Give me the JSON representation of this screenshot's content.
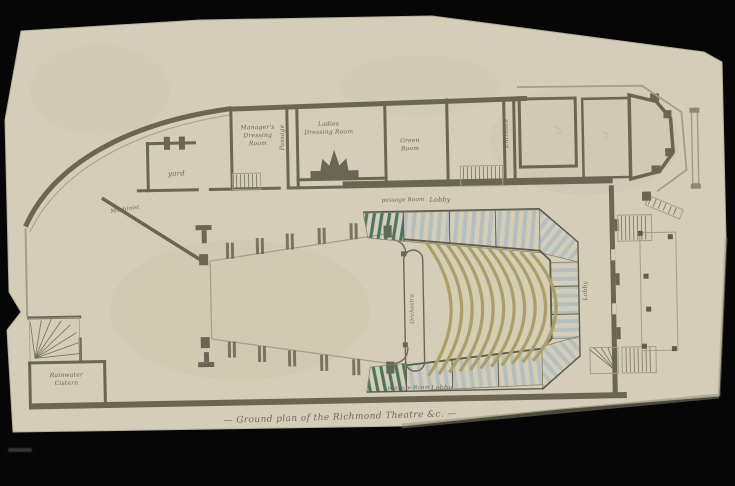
{
  "photo": {
    "background_color": "#060606",
    "paper_color": "#d6cfba",
    "ink_color": "#696653",
    "light_line_color": "#a59e87",
    "pit_bench_color": "#ab9f62",
    "box_stripe_blue": "#b5bfbf",
    "box_stripe_green": "#4a7660",
    "text_color": "#6b6453"
  },
  "title": {
    "inscription": "— Ground plan of the Richmond Theatre &c. —"
  },
  "rooms": {
    "yard": "yard",
    "machinist": "Machinist",
    "managers_dressing_room": "Manager's\nDressing\nRoom",
    "passage": "Passage",
    "ladies_dressing_room": "Ladies\nDressing Room",
    "green_room": "Green\nRoom",
    "entrance": "Entrance",
    "cistern": "Rainwater\nCistern"
  },
  "auditorium": {
    "lobby_top": "Lobby",
    "lobby_bottom": "Lobby",
    "lobby_right": "Lobby",
    "passage_top": "passage Room",
    "passage_bottom": "passage Room",
    "orchestra": "Orchestra",
    "door_number_top": "2",
    "door_number_bottom": "2"
  }
}
